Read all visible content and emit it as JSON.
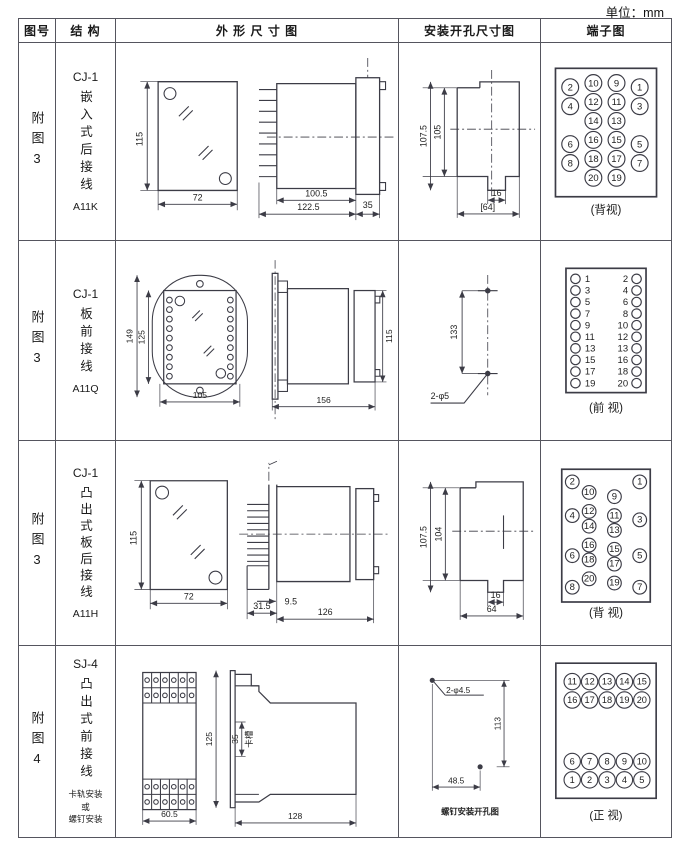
{
  "unit_label": "单位：mm",
  "headers": {
    "fig_no": "图号",
    "structure": "结 构",
    "outline": "外 形 尺 寸 图",
    "mounting": "安装开孔尺寸图",
    "terminal": "端子图"
  },
  "rows": [
    {
      "fig_no": "附图3",
      "model": "CJ-1",
      "desc": "嵌入式后接线",
      "code": "A11K",
      "outline": {
        "front_h": "115",
        "front_w": "72",
        "body_d": "100.5",
        "total_d": "122.5",
        "flange_d": "35"
      },
      "mounting": {
        "outer_h": "107.5",
        "inner_h": "105",
        "tab_w": "16",
        "total_w": "[64]"
      },
      "terminal": {
        "caption": "(背视)",
        "layout": "circles",
        "r": 8,
        "fs": 8.5,
        "circles": [
          [
            "2",
            22,
            24
          ],
          [
            "10",
            44,
            20
          ],
          [
            "9",
            66,
            20
          ],
          [
            "1",
            88,
            24
          ],
          [
            "4",
            22,
            42
          ],
          [
            "12",
            44,
            38
          ],
          [
            "11",
            66,
            38
          ],
          [
            "3",
            88,
            42
          ],
          [
            "14",
            44,
            56
          ],
          [
            "13",
            66,
            56
          ],
          [
            "6",
            22,
            78
          ],
          [
            "16",
            44,
            74
          ],
          [
            "15",
            66,
            74
          ],
          [
            "5",
            88,
            78
          ],
          [
            "8",
            22,
            96
          ],
          [
            "18",
            44,
            92
          ],
          [
            "17",
            66,
            92
          ],
          [
            "7",
            88,
            96
          ],
          [
            "20",
            44,
            110
          ],
          [
            "19",
            66,
            110
          ]
        ]
      }
    },
    {
      "fig_no": "附图3",
      "model": "CJ-1",
      "desc": "板前接线",
      "code": "A11Q",
      "outline": {
        "front_h1": "149",
        "front_h2": "125",
        "front_w": "105",
        "side_d": "156",
        "side_h": "115"
      },
      "mounting": {
        "pitch": "133",
        "holes": "2-φ5"
      },
      "terminal": {
        "caption": "(前 视)",
        "layout": "pairs",
        "pairs": [
          [
            "1",
            "2"
          ],
          [
            "3",
            "4"
          ],
          [
            "5",
            "6"
          ],
          [
            "7",
            "8"
          ],
          [
            "9",
            "10"
          ],
          [
            "11",
            "12"
          ],
          [
            "13",
            "13"
          ],
          [
            "15",
            "16"
          ],
          [
            "17",
            "18"
          ],
          [
            "19",
            "20"
          ]
        ]
      }
    },
    {
      "fig_no": "附图3",
      "model": "CJ-1",
      "desc": "凸出式板后接线",
      "code": "A11H",
      "outline": {
        "front_h": "115",
        "front_w": "72",
        "pin_d": "31.5",
        "gap": "9.5",
        "body_d": "126"
      },
      "mounting": {
        "outer_h": "107.5",
        "inner_h": "104",
        "tab_w": "16",
        "total_w": "64"
      },
      "terminal": {
        "caption": "(背 视)",
        "layout": "circles",
        "r": 6.5,
        "fs": 7,
        "circles": [
          [
            "2",
            24,
            16
          ],
          [
            "1",
            88,
            16
          ],
          [
            "10",
            40,
            26
          ],
          [
            "9",
            64,
            30
          ],
          [
            "12",
            40,
            44
          ],
          [
            "11",
            64,
            48
          ],
          [
            "4",
            24,
            48
          ],
          [
            "3",
            88,
            52
          ],
          [
            "14",
            40,
            58
          ],
          [
            "13",
            64,
            62
          ],
          [
            "16",
            40,
            76
          ],
          [
            "15",
            64,
            80
          ],
          [
            "6",
            24,
            86
          ],
          [
            "18",
            40,
            90
          ],
          [
            "17",
            64,
            94
          ],
          [
            "5",
            88,
            86
          ],
          [
            "20",
            40,
            108
          ],
          [
            "19",
            64,
            112
          ],
          [
            "8",
            24,
            116
          ],
          [
            "7",
            88,
            116
          ]
        ]
      }
    },
    {
      "fig_no": "附图4",
      "model": "SJ-4",
      "desc": "凸出式前接线",
      "code": "卡轨安装\n或\n螺钉安装",
      "outline": {
        "front_w": "60.5",
        "side_h": "125",
        "slot": "35",
        "slot_label": "卡槽",
        "body_d": "128"
      },
      "mounting": {
        "holes": "2-φ4.5",
        "height": "113",
        "width": "48.5",
        "caption": "螺钉安装开孔图"
      },
      "terminal": {
        "caption": "(正 视)",
        "layout": "circles",
        "r": 8,
        "fs": 8.5,
        "circles": [
          [
            "11",
            26,
            26
          ],
          [
            "12",
            43,
            26
          ],
          [
            "13",
            60,
            26
          ],
          [
            "14",
            77,
            26
          ],
          [
            "15",
            94,
            26
          ],
          [
            "16",
            26,
            44
          ],
          [
            "17",
            43,
            44
          ],
          [
            "18",
            60,
            44
          ],
          [
            "19",
            77,
            44
          ],
          [
            "20",
            94,
            44
          ],
          [
            "6",
            26,
            104
          ],
          [
            "7",
            43,
            104
          ],
          [
            "8",
            60,
            104
          ],
          [
            "9",
            77,
            104
          ],
          [
            "10",
            94,
            104
          ],
          [
            "1",
            26,
            122
          ],
          [
            "2",
            43,
            122
          ],
          [
            "3",
            60,
            122
          ],
          [
            "4",
            77,
            122
          ],
          [
            "5",
            94,
            122
          ]
        ]
      }
    }
  ]
}
